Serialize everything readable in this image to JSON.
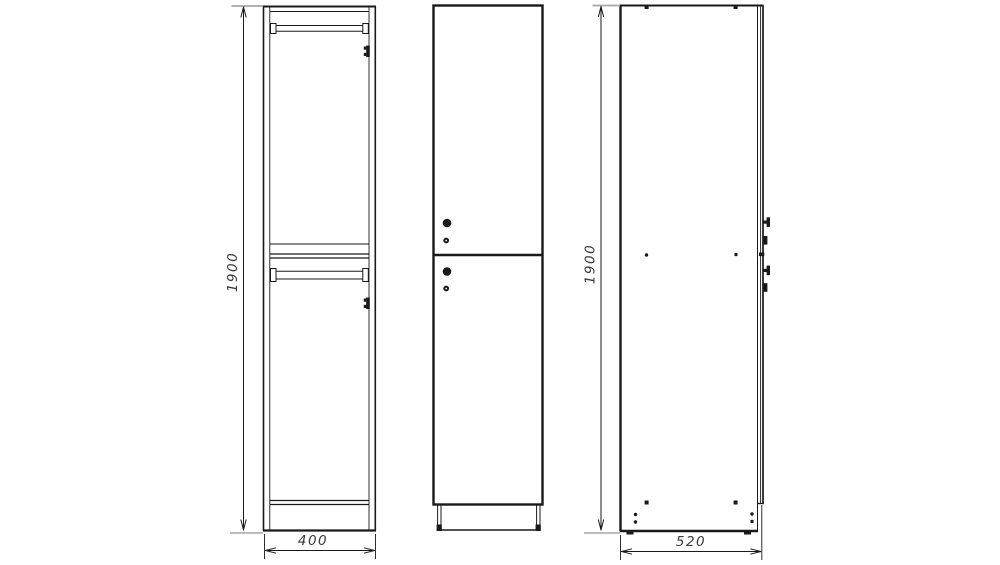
{
  "drawing": {
    "background_color": "#ffffff",
    "line_color": "#1a1a1a",
    "extension_line_color": "#a6a6a6",
    "dimension_text_color": "#3a3a3a",
    "dimensions": {
      "front_height": "1900",
      "front_width": "400",
      "side_height": "1900",
      "side_depth": "520"
    }
  }
}
